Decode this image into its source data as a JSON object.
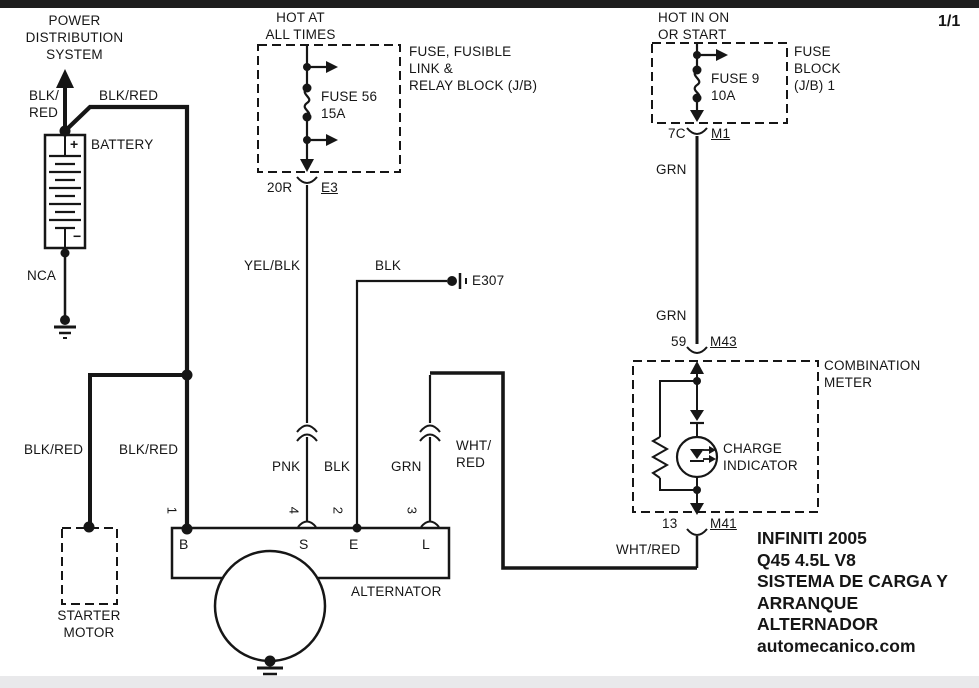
{
  "page": {
    "number": "1/1"
  },
  "power": {
    "title": "POWER\nDISTRIBUTION\nSYSTEM",
    "wire_left": "BLK/\nRED",
    "wire_top": "BLK/RED"
  },
  "battery": {
    "label": "BATTERY",
    "plus": "+",
    "minus": "−",
    "nca": "NCA"
  },
  "fuse_block_left": {
    "header": "HOT AT\nALL TIMES",
    "fuse": "FUSE 56\n15A",
    "block_label": "FUSE, FUSIBLE\nLINK &\nRELAY BLOCK (J/B)",
    "pin": "20R",
    "connector": "E3",
    "wire": "YEL/BLK"
  },
  "fuse_block_right": {
    "header": "HOT IN ON\nOR START",
    "fuse": "FUSE 9\n10A",
    "block_label": "FUSE\nBLOCK\n(J/B) 1",
    "pin": "7C",
    "connector": "M1",
    "wire_upper": "GRN",
    "wire_lower": "GRN"
  },
  "ground_e307": {
    "wire": "BLK",
    "label": "E307"
  },
  "meter": {
    "pin_in": "59",
    "connector_in": "M43",
    "label": "COMBINATION\nMETER",
    "indicator": "CHARGE\nINDICATOR",
    "pin_out": "13",
    "connector_out": "M41",
    "wire_out": "WHT/RED"
  },
  "alternator": {
    "label": "ALTERNATOR",
    "terminal_b": "B",
    "terminal_s": "S",
    "terminal_e": "E",
    "terminal_l": "L",
    "pin_b": "1",
    "pin_s": "4",
    "pin_e": "2",
    "pin_l": "3",
    "wire_s": "PNK",
    "wire_e": "BLK",
    "wire_l": "GRN",
    "wire_l2": "WHT/\nRED"
  },
  "starter": {
    "label": "STARTER\nMOTOR",
    "wire_left": "BLK/RED",
    "wire_right": "BLK/RED"
  },
  "info": {
    "block": "INFINITI 2005\nQ45 4.5L V8\nSISTEMA DE CARGA Y\nARRANQUE\nALTERNADOR\nautomecanico.com"
  },
  "colors": {
    "line": "#161616",
    "topbar": "#1e1e1e",
    "bottombar": "#e9e9eb"
  }
}
